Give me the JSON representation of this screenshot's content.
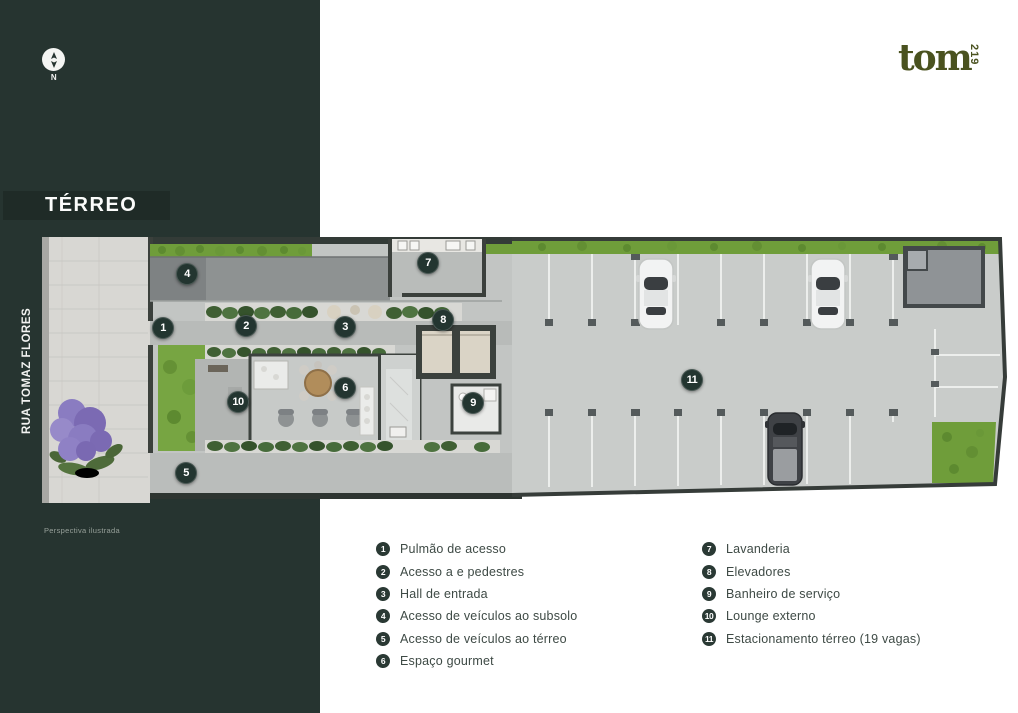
{
  "brand": {
    "logo_text": "tom",
    "logo_number": "219",
    "logo_color": "#4a521f"
  },
  "sidebar": {
    "title": "TÉRREO",
    "street_label": "RUA TOMAZ FLORES",
    "compass": {
      "label": "N"
    },
    "caption": "Perspectiva ilustrada",
    "bg_color": "#263430"
  },
  "plan": {
    "badge_color": "#233530",
    "badges": [
      {
        "n": "1",
        "x": 121,
        "y": 91
      },
      {
        "n": "2",
        "x": 204,
        "y": 89
      },
      {
        "n": "3",
        "x": 303,
        "y": 90
      },
      {
        "n": "4",
        "x": 145,
        "y": 37
      },
      {
        "n": "5",
        "x": 144,
        "y": 236
      },
      {
        "n": "6",
        "x": 303,
        "y": 151
      },
      {
        "n": "7",
        "x": 386,
        "y": 26
      },
      {
        "n": "8",
        "x": 401,
        "y": 83
      },
      {
        "n": "9",
        "x": 431,
        "y": 166
      },
      {
        "n": "10",
        "x": 196,
        "y": 165
      },
      {
        "n": "11",
        "x": 650,
        "y": 143
      }
    ]
  },
  "legend": {
    "left": [
      {
        "n": "1",
        "label": "Pulmão de acesso"
      },
      {
        "n": "2",
        "label": "Acesso a e pedestres"
      },
      {
        "n": "3",
        "label": "Hall de entrada"
      },
      {
        "n": "4",
        "label": "Acesso de veículos ao subsolo"
      },
      {
        "n": "5",
        "label": "Acesso de veículos ao térreo"
      },
      {
        "n": "6",
        "label": "Espaço gourmet"
      }
    ],
    "right": [
      {
        "n": "7",
        "label": "Lavanderia"
      },
      {
        "n": "8",
        "label": "Elevadores"
      },
      {
        "n": "9",
        "label": "Banheiro de serviço"
      },
      {
        "n": "10",
        "label": "Lounge externo"
      },
      {
        "n": "11",
        "label": "Estacionamento térreo (19 vagas)"
      }
    ]
  }
}
